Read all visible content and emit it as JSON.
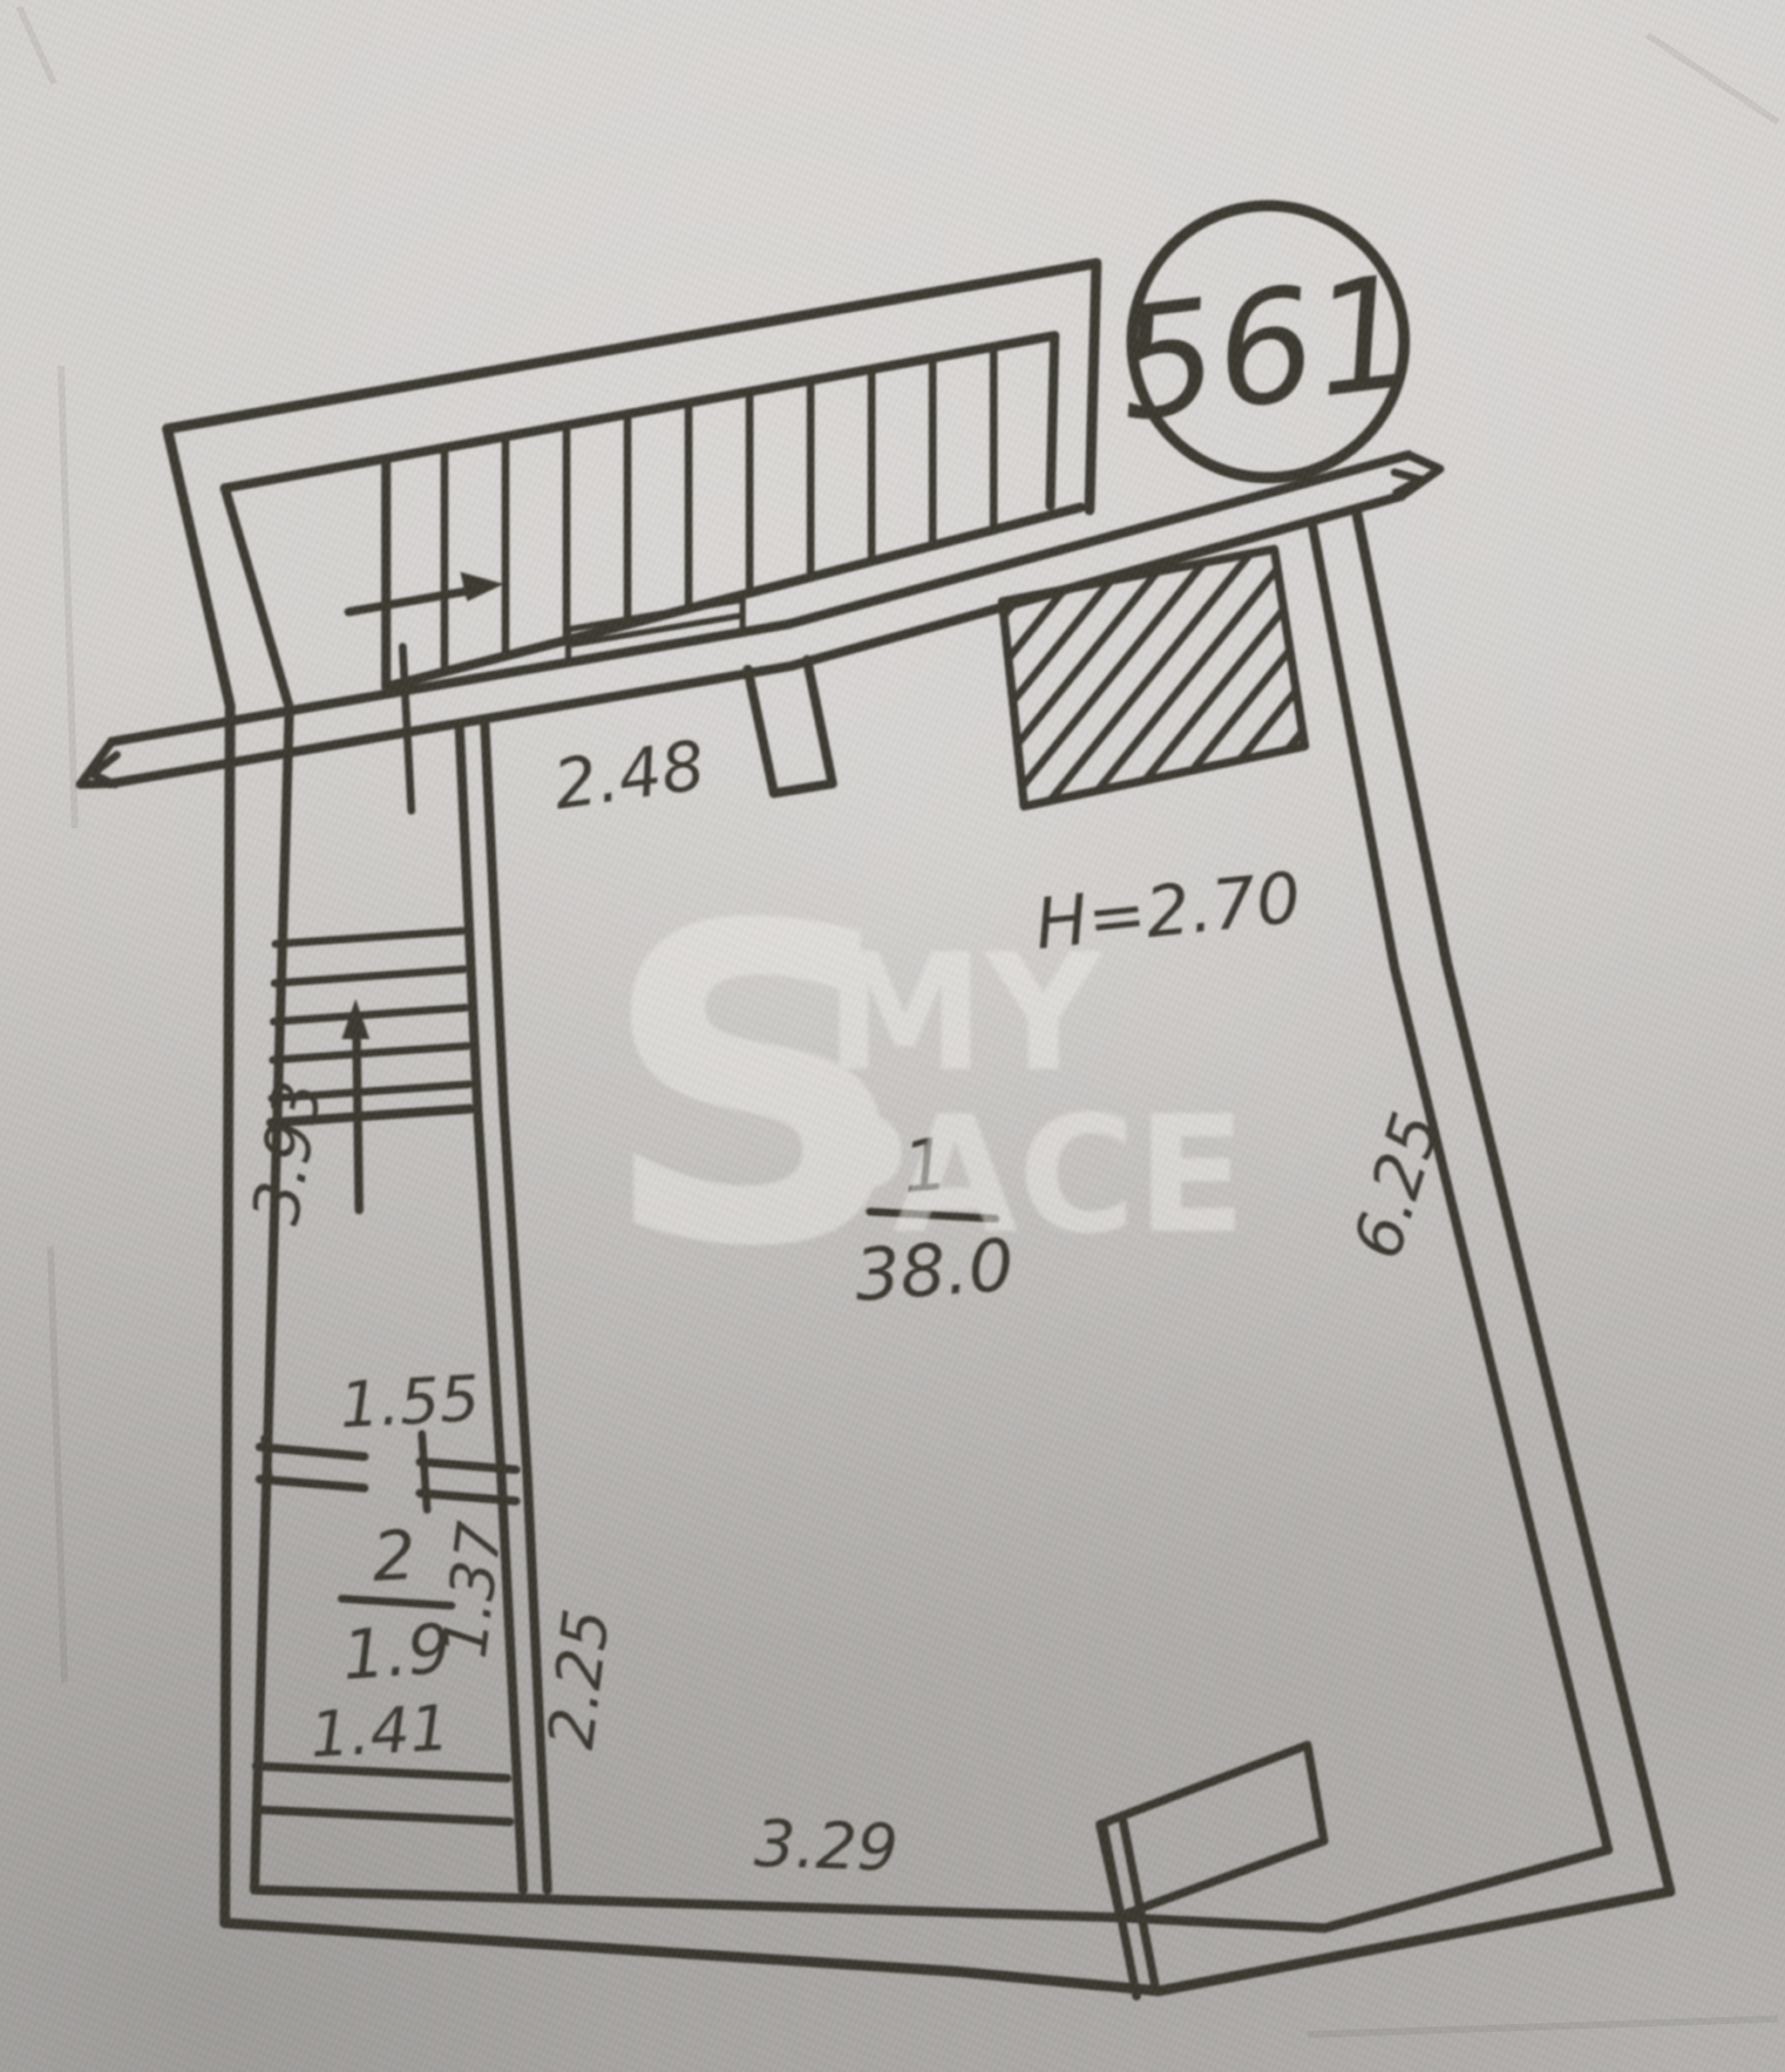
{
  "photo": {
    "paper_color": "#ccc9c6",
    "ink_color": "#34302c",
    "watermark_color": "#efede9"
  },
  "plan": {
    "unit_badge": "561",
    "ceiling_height_label": "H=2.70",
    "watermark": {
      "letter": "S",
      "line1": "MY",
      "line2": "PACE"
    },
    "rooms": [
      {
        "number": "1",
        "area": "38.0"
      },
      {
        "number": "2",
        "area": "1.9"
      }
    ],
    "dimensions": {
      "entry_width": "2.48",
      "stair_run": "3.93",
      "closet_width_top": "1.55",
      "closet_width_bottom": "1.41",
      "closet_depth_inner": "1.37",
      "closet_depth_outer": "2.25",
      "bottom_wall": "3.29",
      "right_wall": "6.25"
    }
  }
}
